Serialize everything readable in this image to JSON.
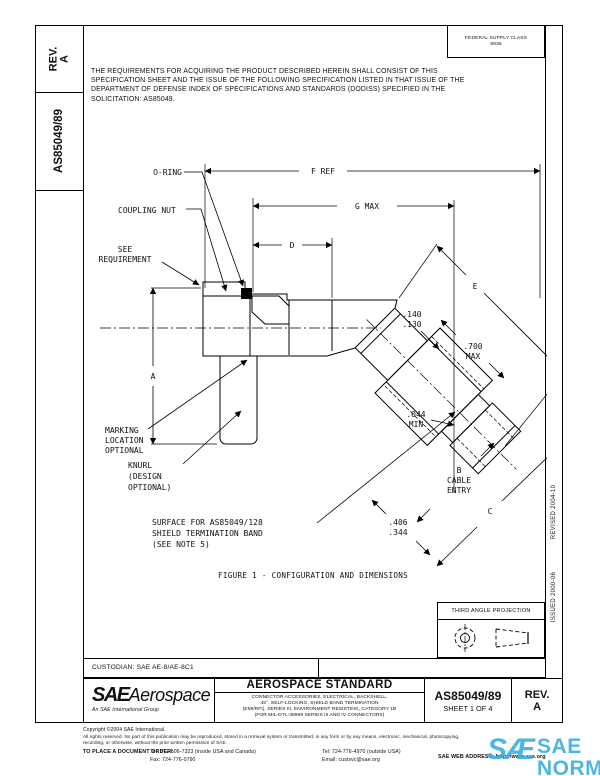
{
  "sidebar": {
    "rev_label": "REV.",
    "rev_value": "A",
    "doc_number": "AS85049/89"
  },
  "fsc": {
    "line1": "FEDERAL SUPPLY CLASS",
    "line2": "5935"
  },
  "requirements": [
    "THE REQUIREMENTS FOR ACQUIRING THE PRODUCT DESCRIBED HEREIN SHALL CONSIST OF THIS",
    "SPECIFICATION SHEET AND THE ISSUE OF THE FOLLOWING SPECIFICATION LISTED IN THAT ISSUE OF THE",
    "DEPARTMENT OF DEFENSE INDEX OF SPECIFICATIONS AND STANDARDS (DODISS) SPECIFIED IN THE",
    "SOLICITATION: AS85049."
  ],
  "margin_right": {
    "revised": "REVISED 2004-10",
    "issued": "ISSUED 2000-06"
  },
  "figure": {
    "caption": "FIGURE 1 - CONFIGURATION AND DIMENSIONS",
    "labels": {
      "oring": "O-RING",
      "coupling_nut": "COUPLING NUT",
      "see1": "SEE",
      "see2": "REQUIREMENT",
      "marking1": "MARKING",
      "marking2": "LOCATION",
      "marking3": "OPTIONAL",
      "knurl1": "KNURL",
      "knurl2": "(DESIGN",
      "knurl3": "OPTIONAL)",
      "surface1": "SURFACE FOR AS85049/128",
      "surface2": "SHIELD TERMINATION BAND",
      "surface3": "(SEE NOTE 5)"
    },
    "dims": {
      "f": "F REF",
      "g": "G MAX",
      "d": "D",
      "a": "A",
      "e": "E",
      "b": "B",
      "c": "C",
      "cable1": "CABLE",
      "cable2": "ENTRY",
      "d140": ".140",
      "d130": ".130",
      "d700": ".700",
      "d700max": "MAX",
      "d044": ".044",
      "d044min": "MIN",
      "d406": ".406",
      "d344": ".344"
    }
  },
  "projection": {
    "label": "THIRD ANGLE PROJECTION"
  },
  "custodian": "CUSTODIAN: SAE AE-8/AE-8C1",
  "title_block": {
    "logo_sae": "SAE",
    "logo_aero": "Aerospace",
    "logo_sub": "An SAE International Group",
    "title": "AEROSPACE STANDARD",
    "subtitle": [
      "CONNECTOR ACCESSORIES, ELECTRICAL, BACKSHELL,",
      "45°, SELF-LOCKING, SHIELD BAND TERMINATION",
      "(EMI/RFI), SERIES III, ENVIRONMENT RESISTING, CATEGORY 1B",
      "(FOR MIL-DTL-38999 SERIES III AND IV CONNECTORS)"
    ],
    "doc_number": "AS85049/89",
    "sheet": "SHEET 1 OF 4",
    "rev_label": "REV.",
    "rev_value": "A"
  },
  "footer": {
    "copyright": "Copyright ©2004 SAE International.",
    "rights1": "All rights reserved. No part of this publication may be reproduced, stored in a retrieval system or transmitted, in any form or by any means, electronic, mechanical, photocopying,",
    "rights2": "recording, or otherwise, without the prior written permission of SAE.",
    "order_label": "TO PLACE A DOCUMENT ORDER:",
    "tel_inside": "Tel: 877-606-7323 (inside USA and Canada)",
    "fax": "Fax: 724-776-0790",
    "tel_outside": "Tel: 724-776-4970 (outside USA)",
    "email": "Email: custsvc@sae.org",
    "web": "SAE WEB ADDRESS: http://www.sae.org"
  },
  "watermark": {
    "mark": "SÆ",
    "text": "SAE NORM",
    "sub_left": "INTERNATIONAL",
    "sub_right": "STANDARDS",
    "color": "#3fb0e0"
  }
}
